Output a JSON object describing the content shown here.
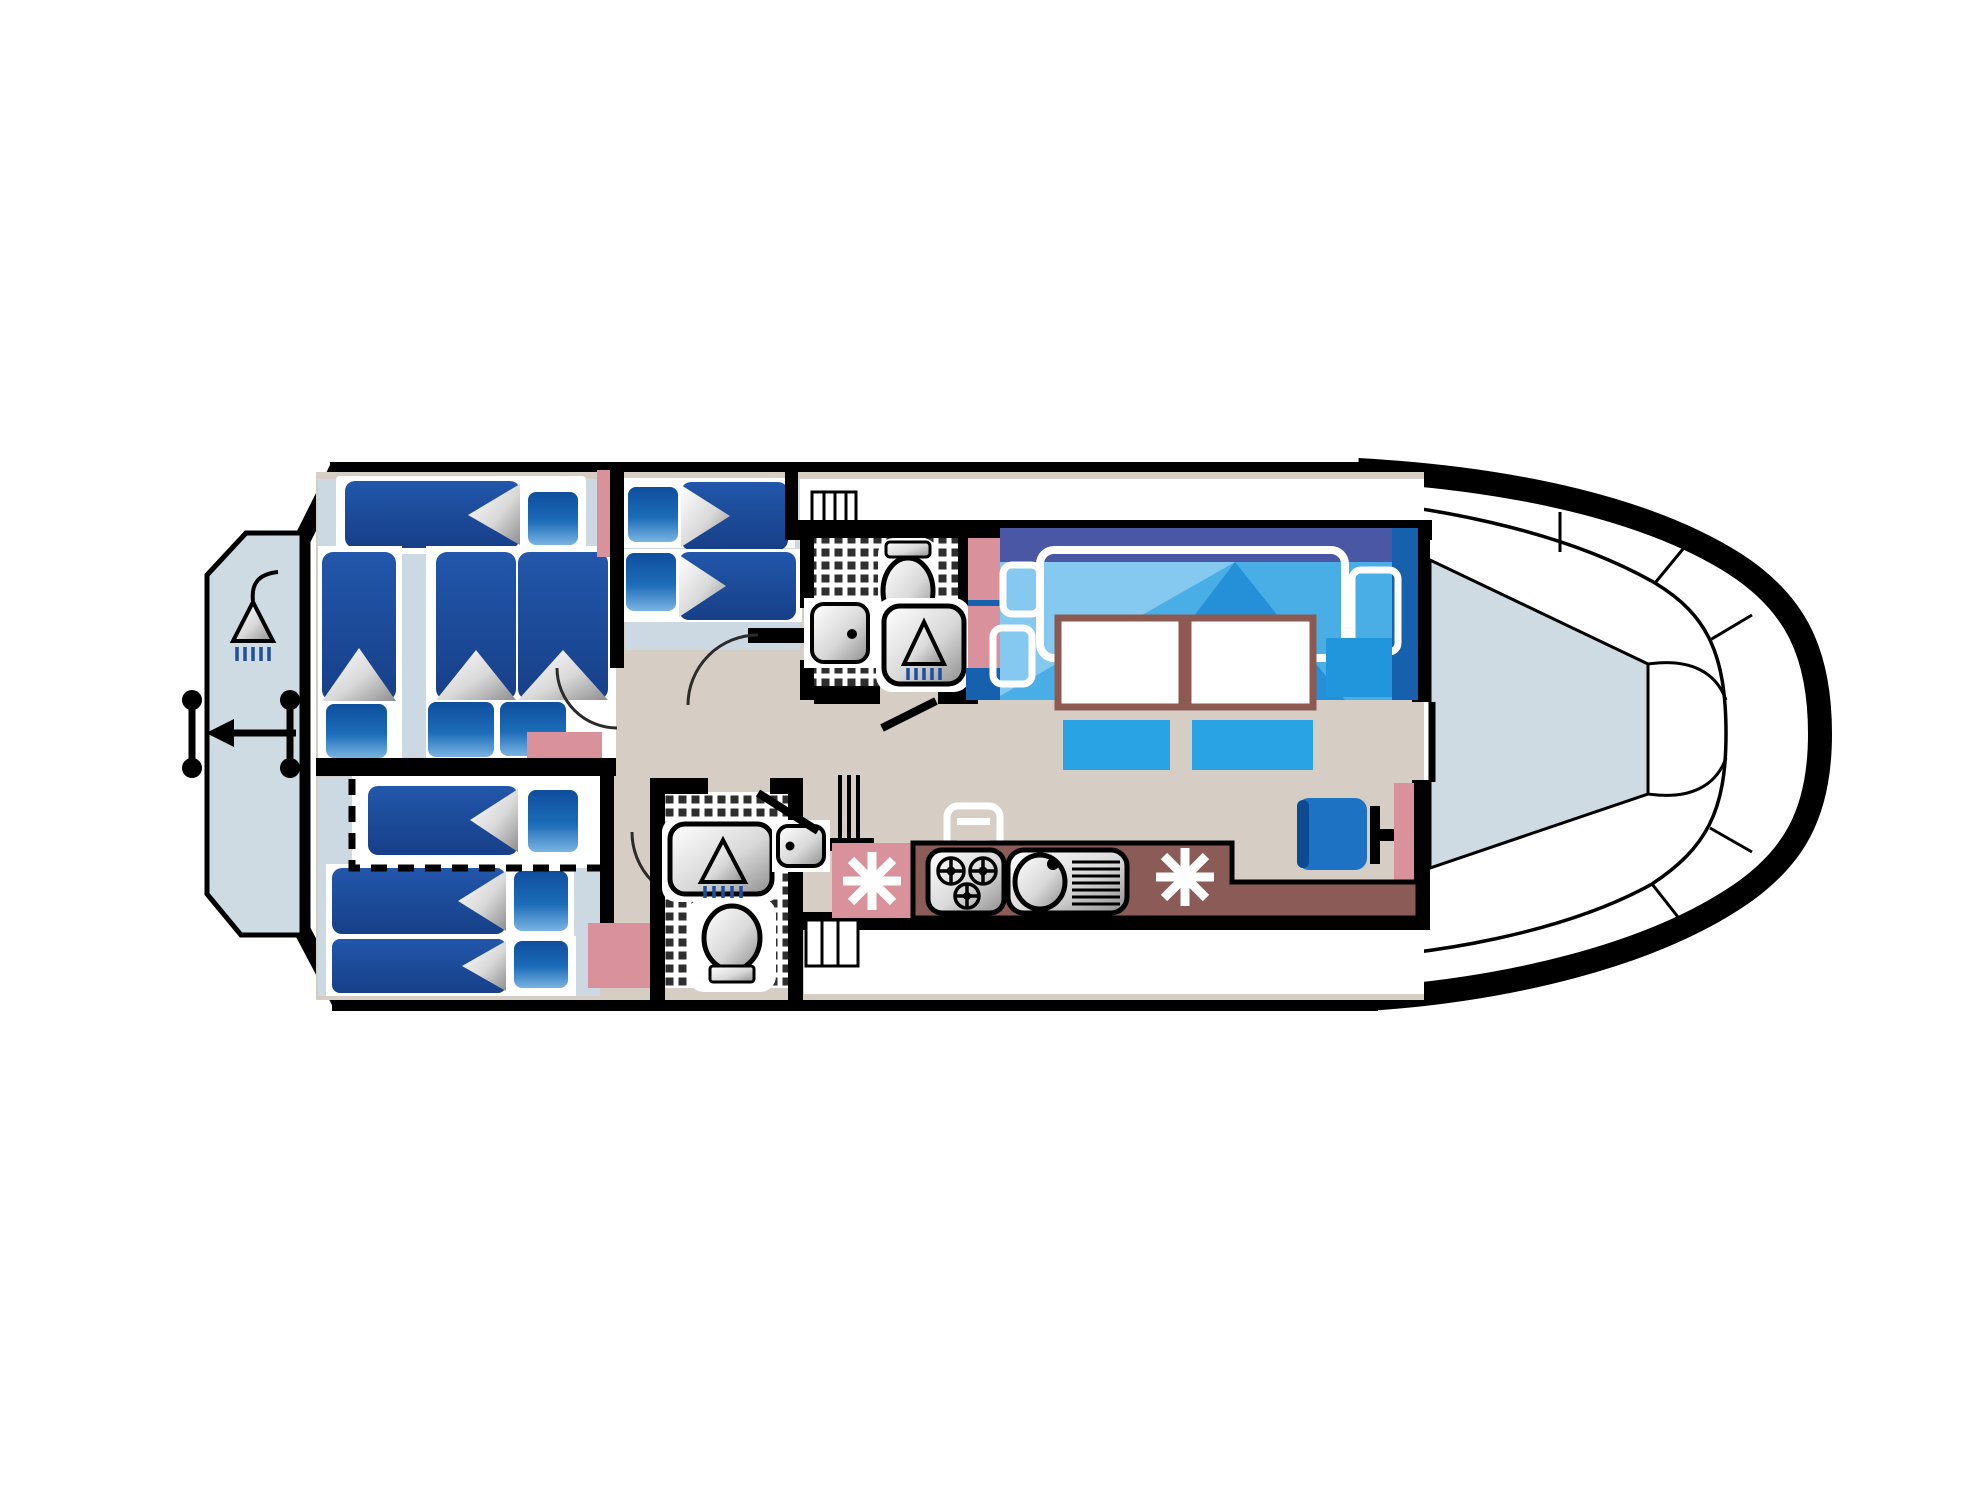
{
  "diagram": {
    "type": "floor-plan",
    "subject": "houseboat deck layout",
    "view": "top-down",
    "bow_side": "right",
    "stern_side": "left"
  },
  "palette": {
    "white": "#ffffff",
    "wall": "#000000",
    "floor_tan": "#d6cec5",
    "cabin_floor": "#ccd9e3",
    "deck_gray": "#cfdbe3",
    "mattress": "#1c4a9e",
    "bed_light": "#85c8f0",
    "bed_base": "#4aaee6",
    "bed_mid": "#2590d8",
    "bed_band": "#4a57a5",
    "bed_dark": "#1760ae",
    "bench": "#29a3e3",
    "cushion": "#2196dd",
    "helm": "#1d72c4",
    "pink": "#d9929b",
    "counter": "#8b5b57",
    "table_border": "#8d5a52",
    "tick_blue": "#1d4f9e",
    "arc_line": "#2b2b2b"
  },
  "rooms": [
    {
      "name": "stern platform",
      "features": [
        "deck shower",
        "boarding ladder",
        "boarding ladder",
        "exit arrow"
      ]
    },
    {
      "name": "aft cabin",
      "furniture": [
        "athwart single berth",
        "single berth",
        "double berth pair"
      ],
      "pillows": 4
    },
    {
      "name": "mid cabin",
      "furniture": [
        "single berth",
        "single berth"
      ],
      "pillows": 2
    },
    {
      "name": "lower cabin",
      "furniture": [
        "folding berth (dashed outline)",
        "single berth",
        "single berth"
      ],
      "pillows": 3
    },
    {
      "name": "fore bathroom",
      "fixtures": [
        "toilet",
        "washbasin",
        "shower"
      ],
      "floor": "checkered tile"
    },
    {
      "name": "aft bathroom",
      "fixtures": [
        "shower",
        "washbasin",
        "toilet"
      ],
      "floor": "checkered tile"
    },
    {
      "name": "galley",
      "equipment": [
        "refrigerator",
        "3-burner stove",
        "sink with drainer",
        "oven",
        "refrigerator"
      ]
    },
    {
      "name": "saloon",
      "furniture": [
        "transverse double bed",
        "table",
        "table",
        "bench",
        "bench",
        "side cushion",
        "helm seat",
        "steering column"
      ]
    },
    {
      "name": "bow deck",
      "features": [
        "center walkway",
        "side decks"
      ]
    }
  ],
  "stairs": [
    "side-deck steps",
    "companionway steps",
    "boarding steps"
  ],
  "door_count": 5,
  "berth_count": 9
}
